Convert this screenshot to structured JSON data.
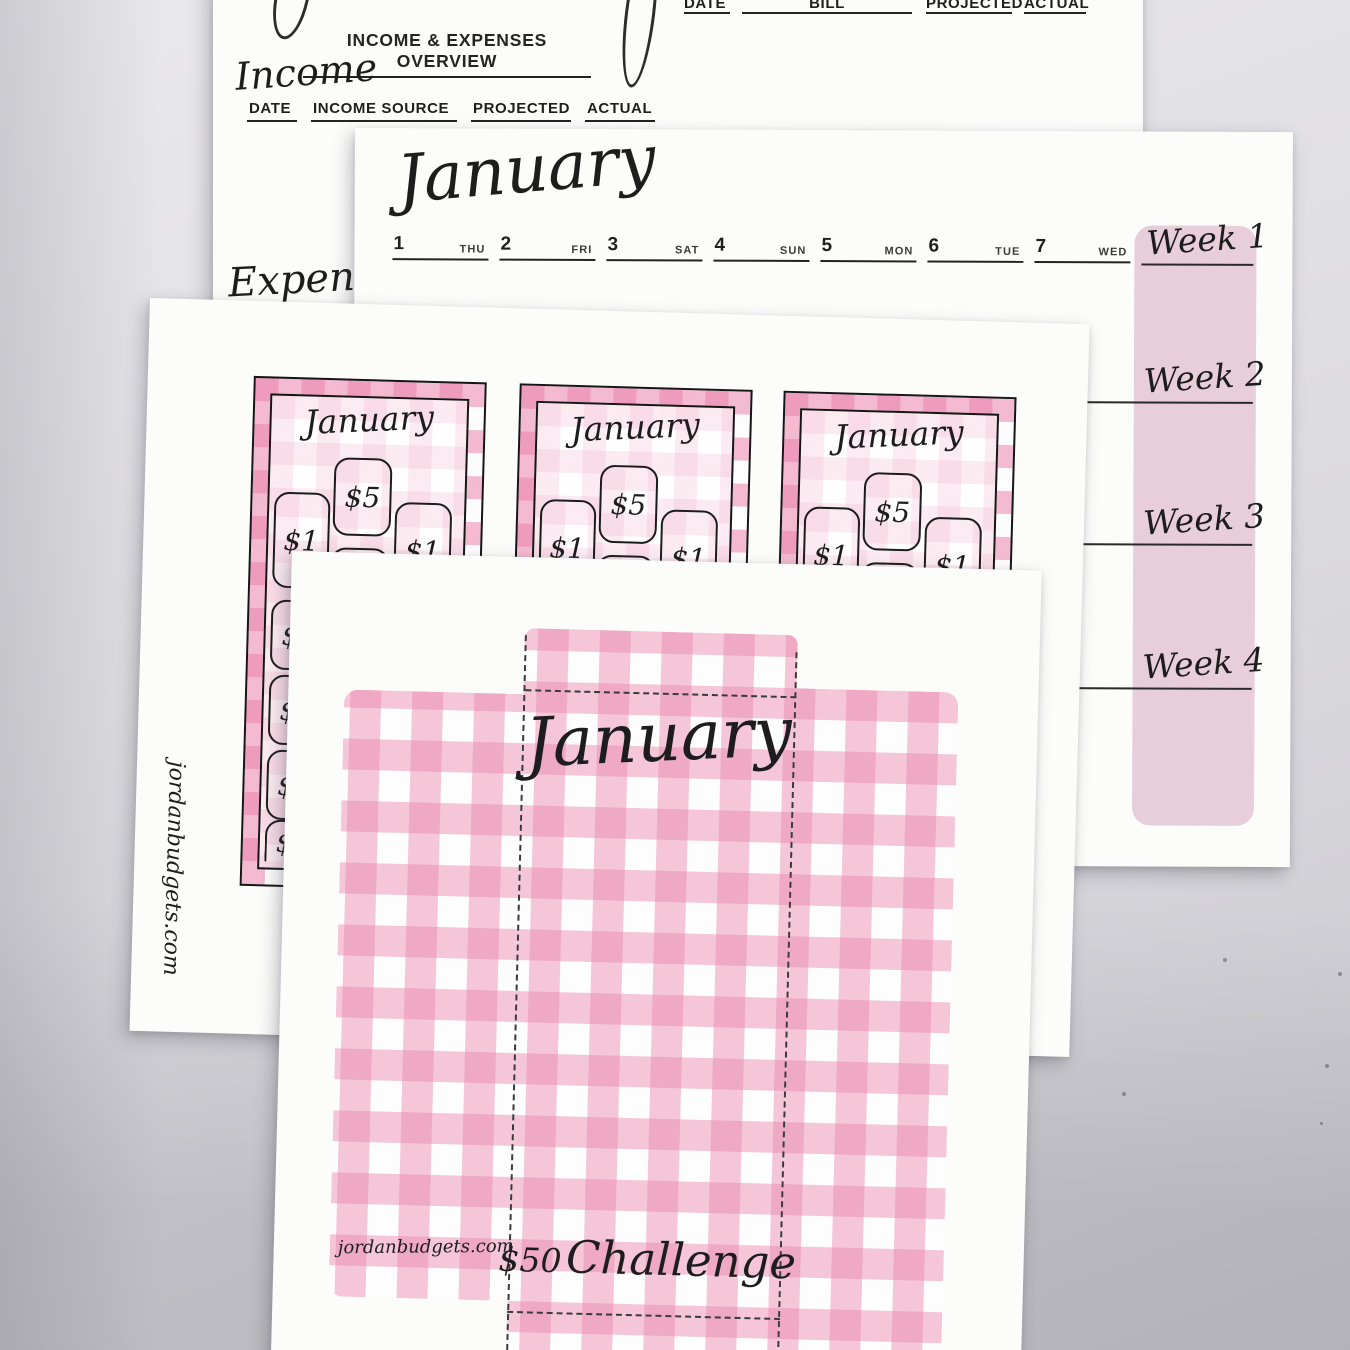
{
  "overview_sheet": {
    "heading": "INCOME & EXPENSES OVERVIEW",
    "income_section_label": "Income",
    "expense_section_label": "Expense",
    "income_columns": [
      "DATE",
      "INCOME SOURCE",
      "PROJECTED",
      "ACTUAL"
    ],
    "bill_columns": [
      "DATE",
      "BILL",
      "PROJECTED",
      "ACTUAL"
    ]
  },
  "weekly_sheet": {
    "month_title": "January",
    "days": [
      {
        "date": "1",
        "weekday": "THU"
      },
      {
        "date": "2",
        "weekday": "FRI"
      },
      {
        "date": "3",
        "weekday": "SAT"
      },
      {
        "date": "4",
        "weekday": "SUN"
      },
      {
        "date": "5",
        "weekday": "MON"
      },
      {
        "date": "6",
        "weekday": "TUE"
      },
      {
        "date": "7",
        "weekday": "WED"
      }
    ],
    "week_labels": [
      "Week 1",
      "Week 2",
      "Week 3",
      "Week 4"
    ]
  },
  "cards_sheet": {
    "website": "jordanbudgets.com",
    "cards": [
      {
        "month": "January",
        "top_amount": "$5",
        "left_amount": "$1",
        "right_amount": "$1",
        "middle_amount": "$1",
        "column_amounts": [
          "$1",
          "$1",
          "$1",
          "$1"
        ]
      },
      {
        "month": "January",
        "top_amount": "$5",
        "left_amount": "$1",
        "right_amount": "$1",
        "middle_amount": "$1"
      },
      {
        "month": "January",
        "top_amount": "$5",
        "left_amount": "$1",
        "right_amount": "$1",
        "middle_amount": "$1"
      }
    ]
  },
  "envelope_sheet": {
    "month_title": "January",
    "challenge_amount": "$50",
    "challenge_word": "Challenge",
    "website": "jordanbudgets.com"
  },
  "colors": {
    "gingham_pink": "#EA8AB0",
    "week_column_pink": "#E8CDDB",
    "paper_white": "#FCFCFB",
    "ink": "#1F1F1F"
  }
}
